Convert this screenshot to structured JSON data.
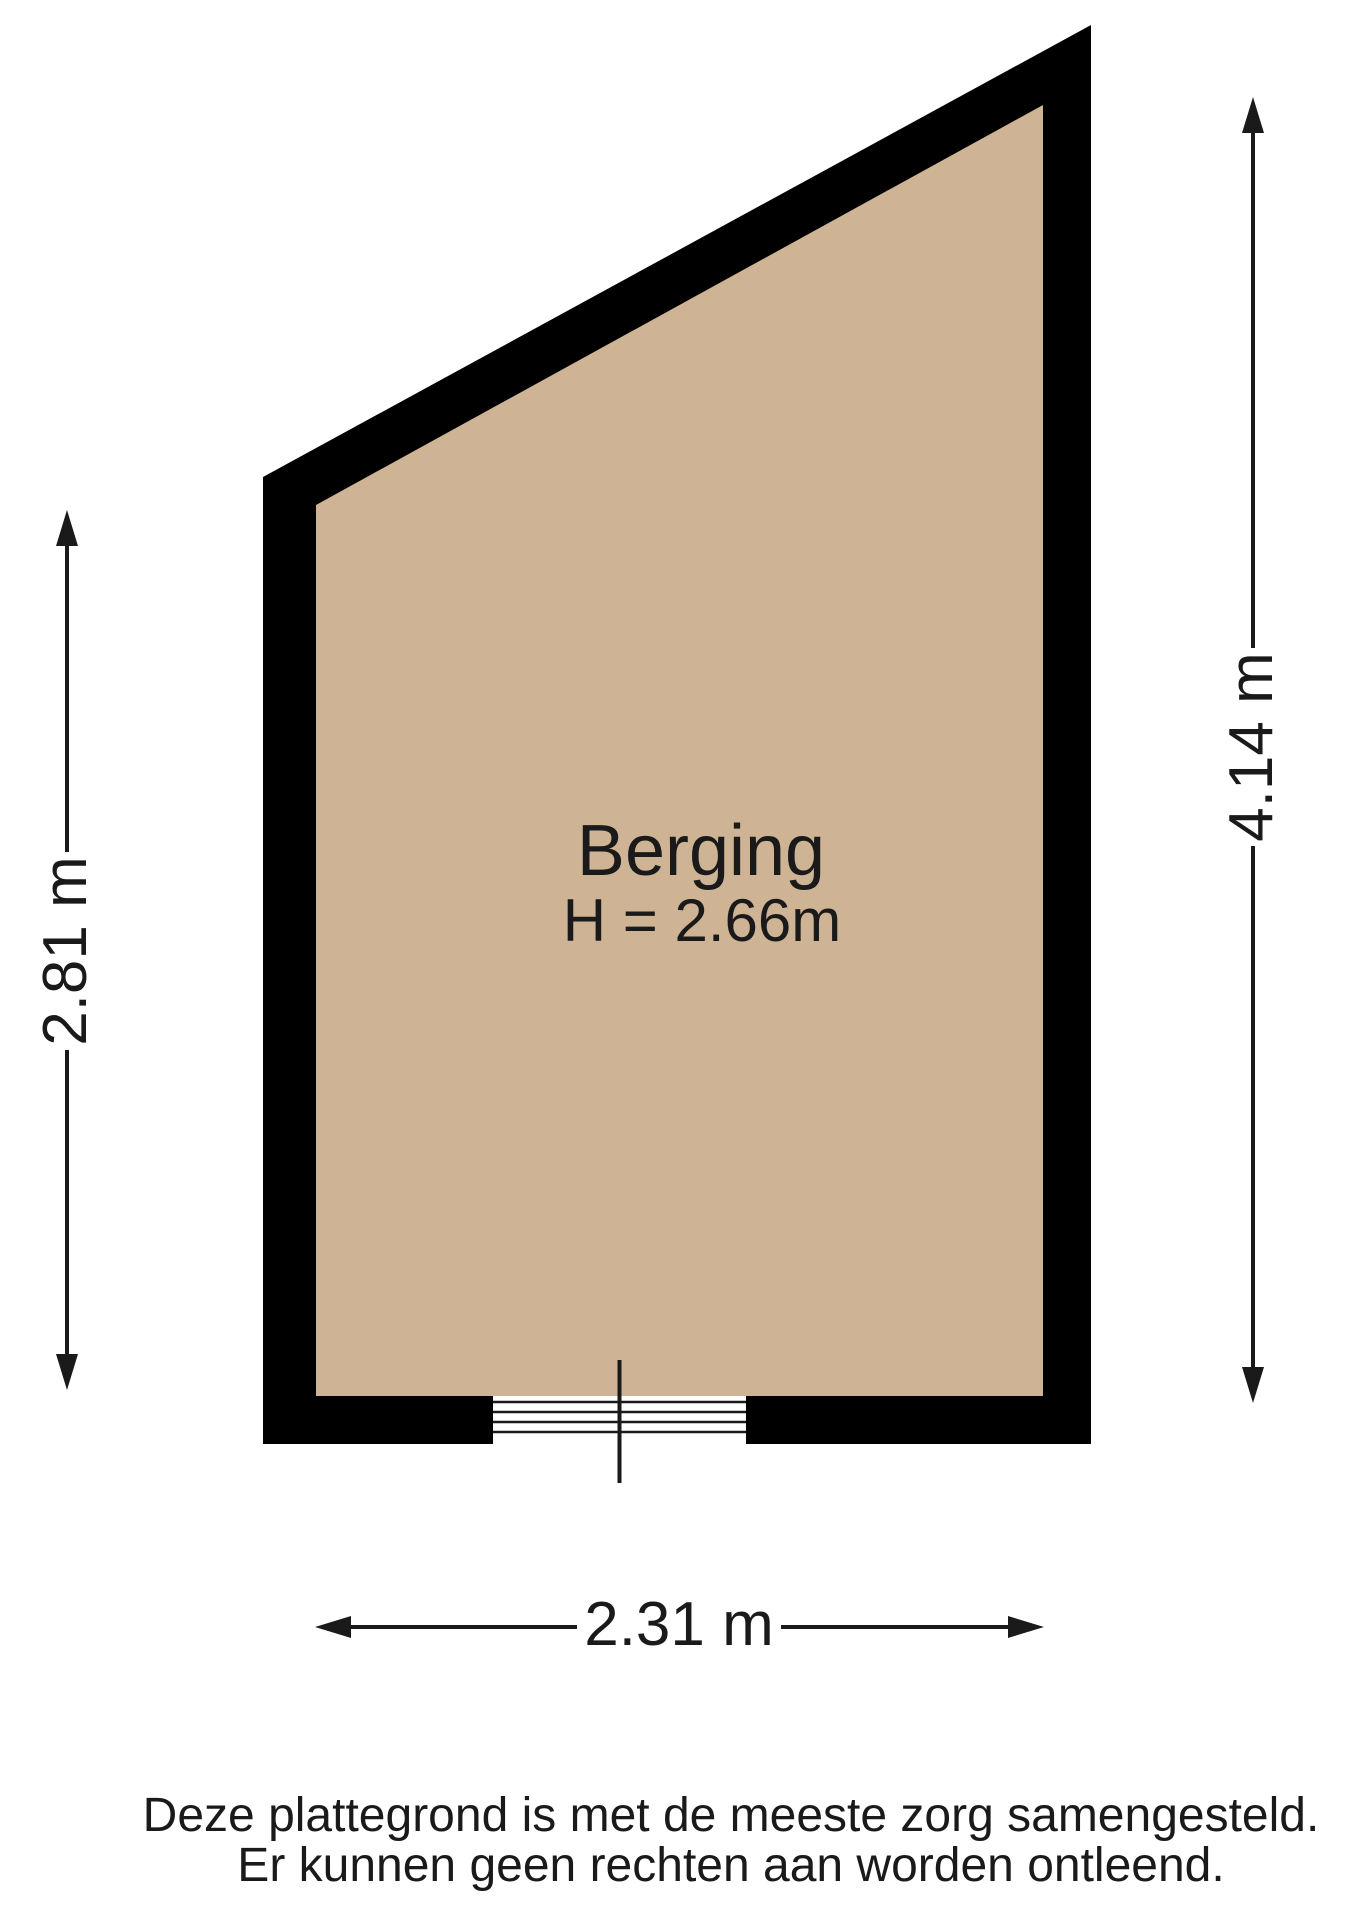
{
  "plan": {
    "room_label": "Berging",
    "ceiling_height_label": "H = 2.66m",
    "dimensions": {
      "left_label": "2.81 m",
      "right_label": "4.14 m",
      "bottom_label": "2.31 m"
    },
    "colors": {
      "wall": "#000000",
      "floor": "#ceb494",
      "line": "#1a1a1a"
    }
  },
  "footer": {
    "disclaimer_line1": "Deze plattegrond is met de meeste zorg samengesteld.",
    "disclaimer_line2": "Er kunnen geen rechten aan worden ontleend."
  }
}
